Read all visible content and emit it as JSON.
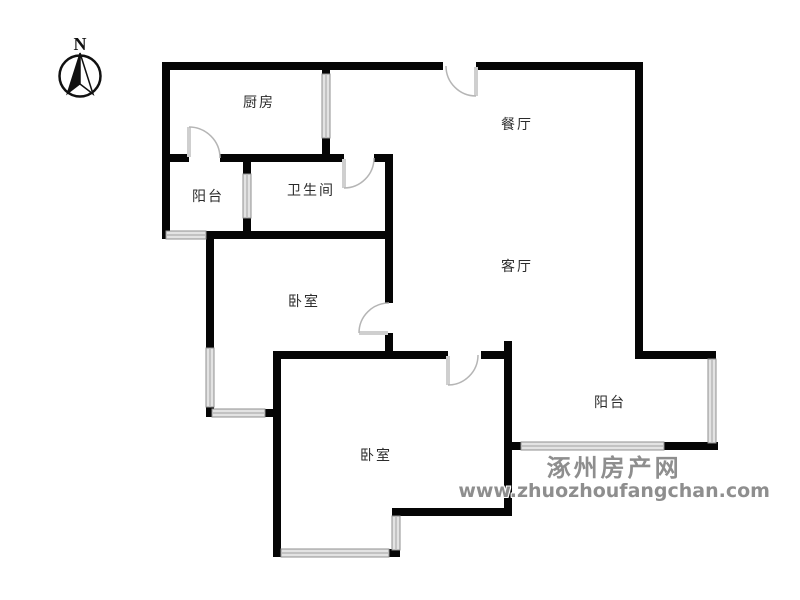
{
  "compass": {
    "label": "N"
  },
  "rooms": [
    {
      "id": "kitchen",
      "label": "厨房"
    },
    {
      "id": "dining-room",
      "label": "餐厅"
    },
    {
      "id": "balcony-north",
      "label": "阳台"
    },
    {
      "id": "bathroom",
      "label": "卫生间"
    },
    {
      "id": "bedroom-west",
      "label": "卧室"
    },
    {
      "id": "living-room",
      "label": "客厅"
    },
    {
      "id": "balcony-south",
      "label": "阳台"
    },
    {
      "id": "bedroom-south",
      "label": "卧室"
    }
  ],
  "watermark": {
    "site_name": "涿州房产网",
    "site_url": "www.zhuozhoufangchan.com"
  },
  "colors": {
    "wall": "#050505",
    "window_fill": "#e3e3e3",
    "window_edge": "#8f8f8f",
    "door": "#b5b5b5",
    "door_leaf": "#cfcfcf",
    "watermark": "#8e8e8e",
    "background": "#ffffff"
  }
}
